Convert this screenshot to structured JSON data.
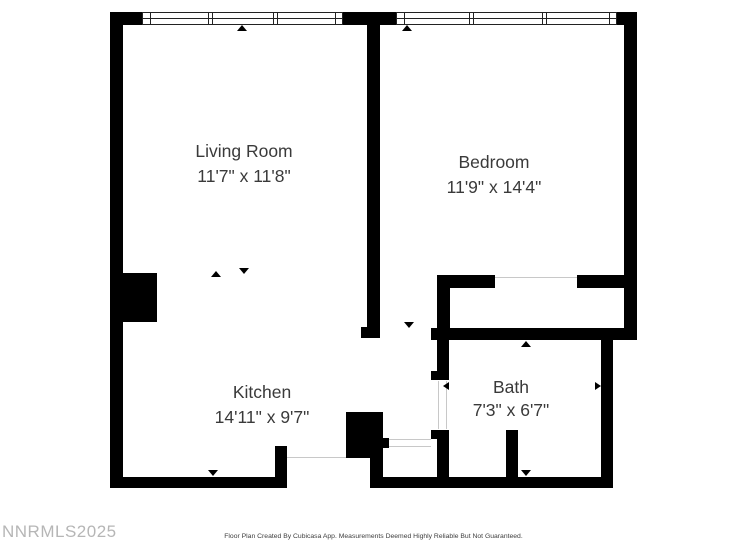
{
  "document": {
    "type": "floor-plan",
    "watermark": "NNRMLS2025",
    "footer": "Floor Plan Created By Cubicasa App. Measurements Deemed Highly Reliable But Not Guaranteed."
  },
  "colors": {
    "background": "#ffffff",
    "wall": "#000000",
    "label_text": "#3a3a3a",
    "watermark_text": "#b6b6b6",
    "footer_text": "#3d3d3d",
    "opening_line": "#c8c8c8"
  },
  "rooms": [
    {
      "id": "living-room",
      "name": "Living Room",
      "dimensions": "11'7\" x 11'8\""
    },
    {
      "id": "bedroom",
      "name": "Bedroom",
      "dimensions": "11'9\" x 14'4\""
    },
    {
      "id": "kitchen",
      "name": "Kitchen",
      "dimensions": "14'11\" x 9'7\""
    },
    {
      "id": "bath",
      "name": "Bath",
      "dimensions": "7'3\" x 6'7\""
    }
  ]
}
